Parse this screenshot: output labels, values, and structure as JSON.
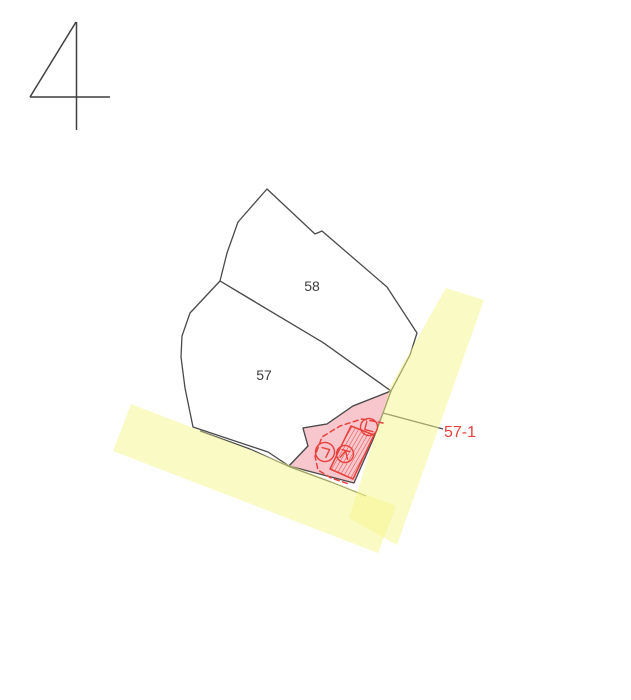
{
  "figure": {
    "number": "4"
  },
  "colors": {
    "background": "#ffffff",
    "boundary_line": "#4a4a4a",
    "parcel_fill": "#ffffff",
    "highlight_pink": "#f8c7cd",
    "highlight_red": "#e8413c",
    "road_yellow": "rgba(245,245,140,0.5)",
    "label_dark": "#3c3c3c"
  },
  "map": {
    "parcels": [
      {
        "id": "parcel-58",
        "label": "58",
        "label_x": 312,
        "label_y": 291,
        "fill": "#ffffff",
        "points": "267,189 315,234 322,231 387,287 417,333 410,355 391,391 325,344 322,342 220,281 227,253 238,222"
      },
      {
        "id": "parcel-57",
        "label": "57",
        "label_x": 264,
        "label_y": 380,
        "fill": "#ffffff",
        "points": "220,281 322,342 325,344 391,391 353,406 327,424 303,428 308,446 289,466 268,452 193,427 185,388 181,357 182,336 190,313"
      },
      {
        "id": "parcel-57-1",
        "label": "",
        "fill": "#f8c7cd",
        "points": "391,391 353,406 327,424 303,428 308,446 289,466 354,483 375,435"
      }
    ],
    "roads": [
      {
        "id": "road-strip-right",
        "points": "446,288 484,300 452,390 397,545 349,518 391,385"
      },
      {
        "id": "road-strip-bottom",
        "points": "131,404 396,506 378,553 113,451"
      }
    ],
    "extra_lines": [
      {
        "id": "boundary-sliver-line",
        "points": "200,431 250,449 290,467 331,482 366,496"
      }
    ],
    "highlight": {
      "dashed_outline_points": "383,423 362,419 340,426 322,437 315,456 318,470 331,478 349,484",
      "hatch_area_points": "351,426 374,435 353,479 330,469",
      "markers": [
        {
          "id": "marker-giyeok",
          "x": 325,
          "y": 452,
          "r": 9.5,
          "glyph": "giyeok"
        },
        {
          "id": "marker-center",
          "x": 345,
          "y": 454,
          "r": 8.5,
          "glyph": "dense"
        },
        {
          "id": "marker-nieun",
          "x": 369,
          "y": 427,
          "r": 8.5,
          "glyph": "nieun"
        }
      ]
    },
    "callout": {
      "label": "57-1",
      "line_points": "383,413 443,429",
      "text_x": 444,
      "text_y": 437
    }
  },
  "figure_number_lines": [
    [
      76,
      22,
      30,
      97
    ],
    [
      30,
      97,
      110,
      97
    ],
    [
      76.5,
      22,
      76.5,
      130
    ]
  ]
}
